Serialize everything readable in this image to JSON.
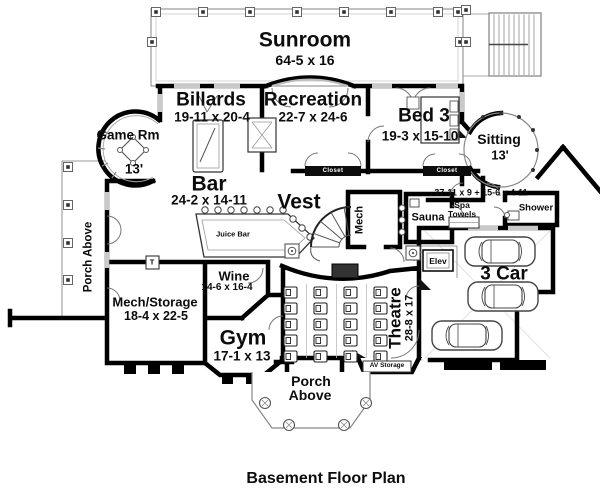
{
  "caption": "Basement Floor Plan",
  "colors": {
    "wall": "#000000",
    "thin_line": "#777777",
    "background": "#ffffff"
  },
  "fixtures": {
    "thermostat_mark": "T"
  },
  "rooms": {
    "sunroom": {
      "name": "Sunroom",
      "dim": "64-5 x 16"
    },
    "billards": {
      "name": "Billards",
      "dim": "19-11 x 20-4"
    },
    "recreation": {
      "name": "Recreation",
      "dim": "22-7 x 24-6"
    },
    "bed3": {
      "name": "Bed 3",
      "dim": "19-3 x 15-10"
    },
    "game_room": {
      "name": "Game Rm",
      "dim": "13'"
    },
    "sitting": {
      "name": "Sitting",
      "dim": "13'"
    },
    "bar": {
      "name": "Bar",
      "dim": "24-2 x 14-11"
    },
    "juice_bar": {
      "name": "Juice Bar"
    },
    "vest": {
      "name": "Vest"
    },
    "mech": {
      "name": "Mech"
    },
    "porch_left": {
      "name": "Porch Above"
    },
    "hall": {
      "dim": "37-11 x 9 + 15-6 x 4-11"
    },
    "sauna": {
      "name": "Sauna"
    },
    "spa_towels": {
      "line1": "Spa",
      "line2": "Towels"
    },
    "shower": {
      "name": "Shower"
    },
    "closet_left": {
      "name": "Closet"
    },
    "closet_right": {
      "name": "Closet"
    },
    "elevator": {
      "name": "Elev"
    },
    "garage": {
      "name": "3 Car"
    },
    "theatre": {
      "name": "Theatre",
      "dim": "28-8 x 17"
    },
    "av_storage": {
      "name": "AV Storage"
    },
    "gym": {
      "name": "Gym",
      "dim": "17-1 x 13"
    },
    "wine": {
      "name": "Wine",
      "dim": "14-6 x 16-4"
    },
    "mech_storage": {
      "name": "Mech/Storage",
      "dim": "18-4 x 22-5"
    },
    "porch_bottom": {
      "line1": "Porch",
      "line2": "Above"
    }
  }
}
